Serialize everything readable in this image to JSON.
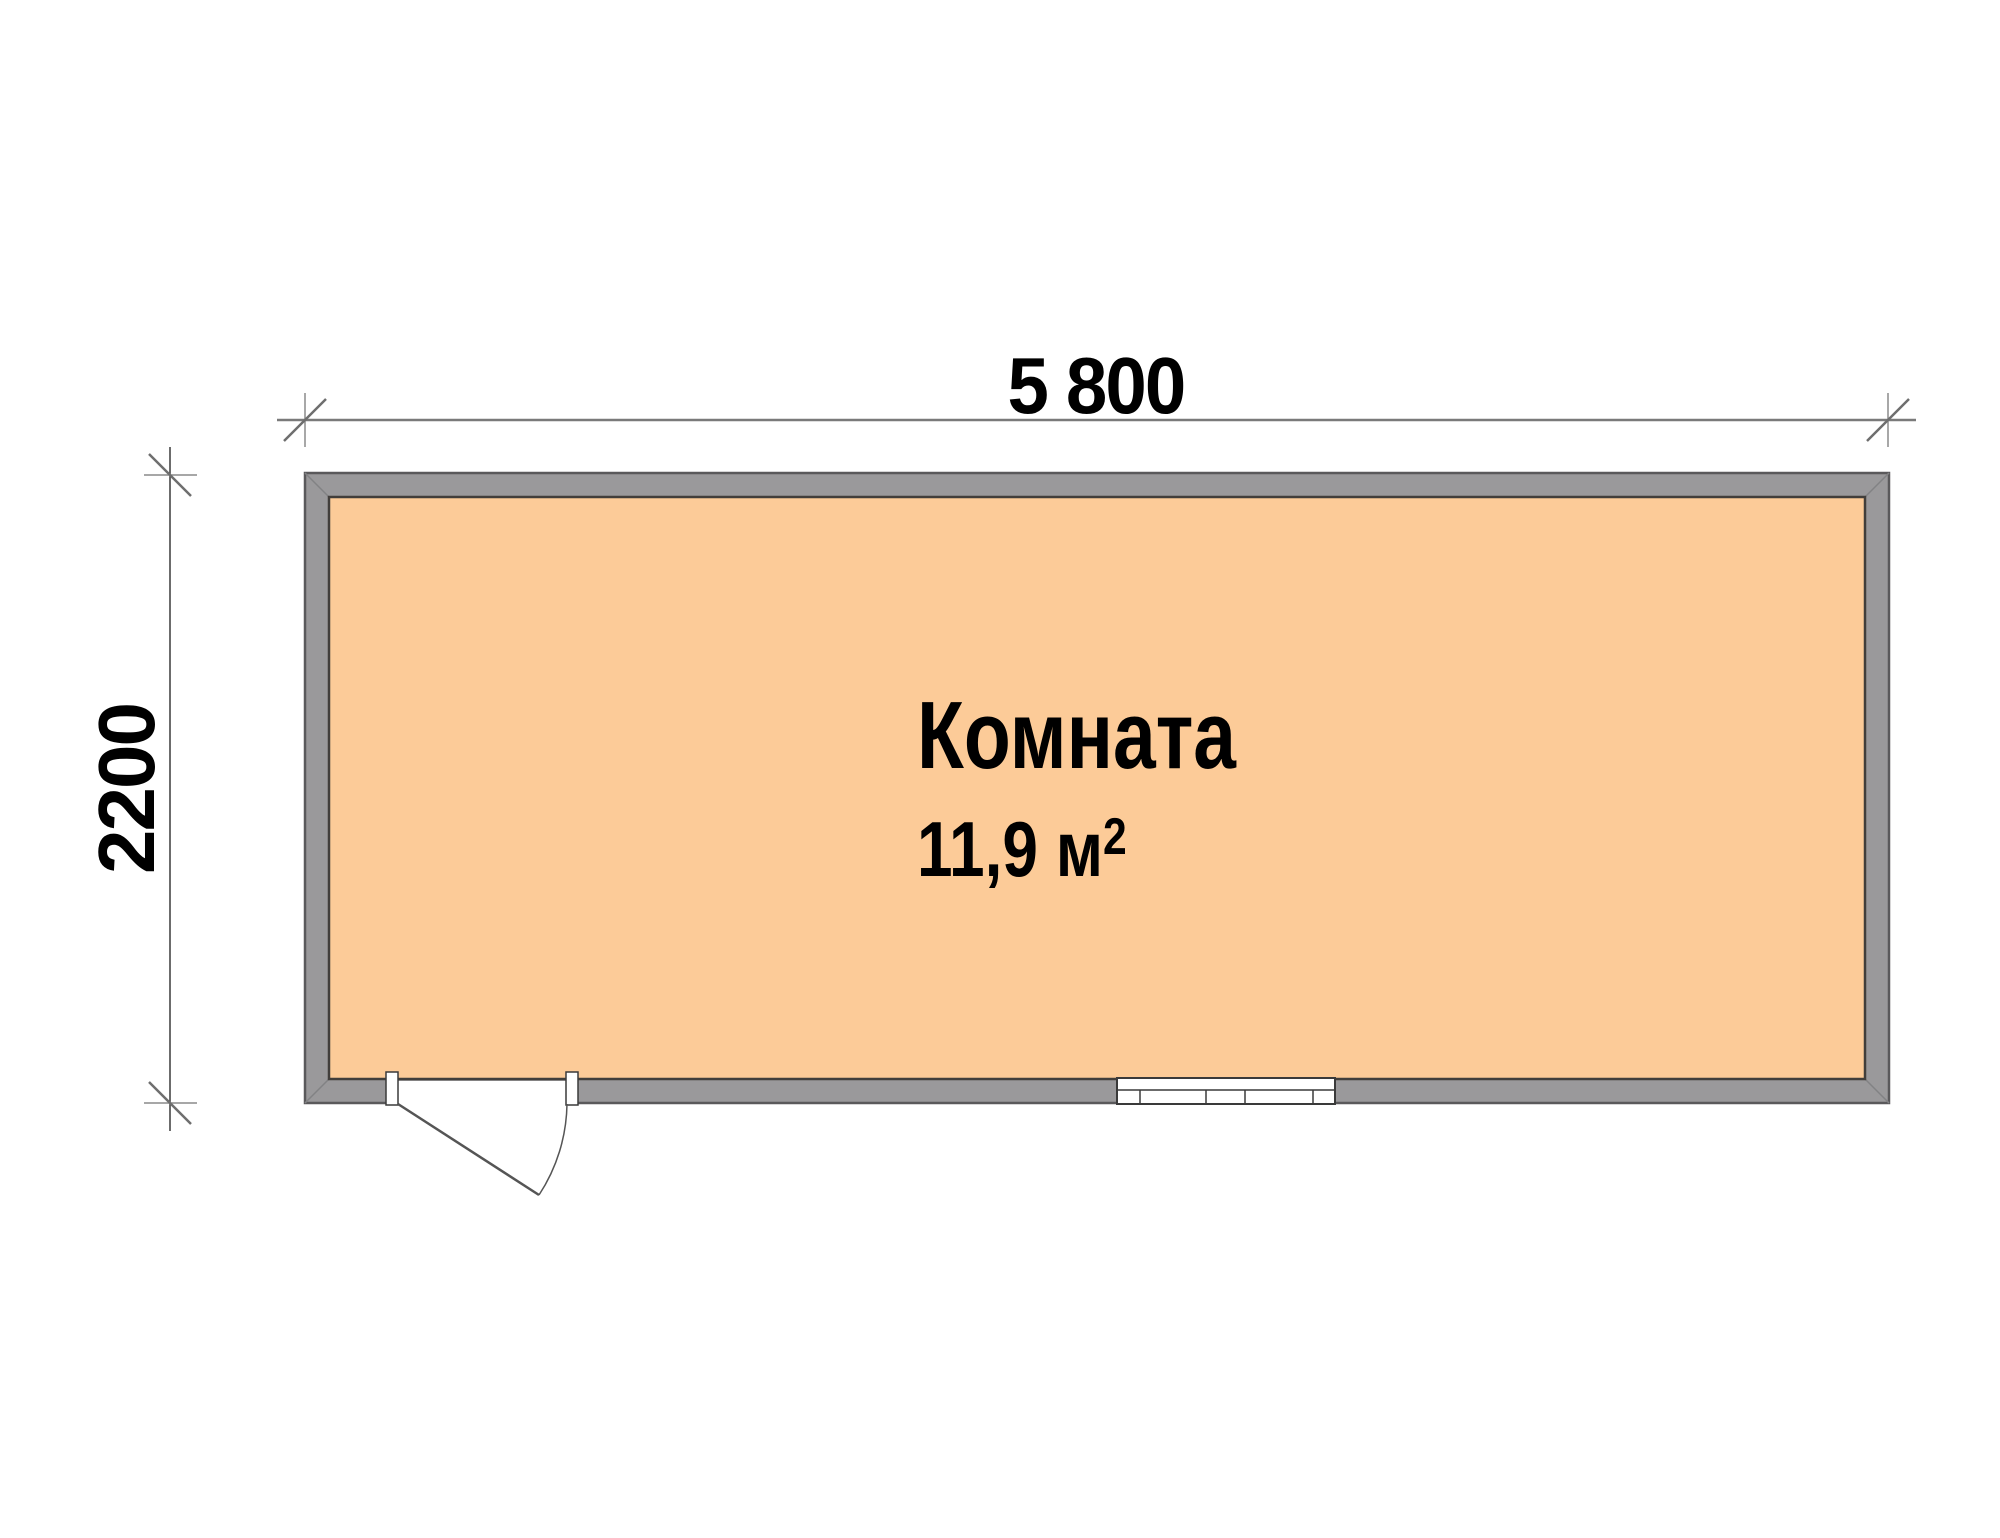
{
  "room": {
    "name": "Комната",
    "area_value": "11,9 м",
    "area_exponent": "2"
  },
  "dimensions": {
    "width_label": "5 800",
    "height_label": "2200"
  },
  "colors": {
    "background": "#FFFFFF",
    "floor": "#FCCB98",
    "wall": "#9A999B",
    "wall_outline": "#5A595B",
    "floor_outline": "#413E3B",
    "dimension_line": "#7A7A7A",
    "tick_slash": "#6E6E6E",
    "label_text": "#000000"
  }
}
